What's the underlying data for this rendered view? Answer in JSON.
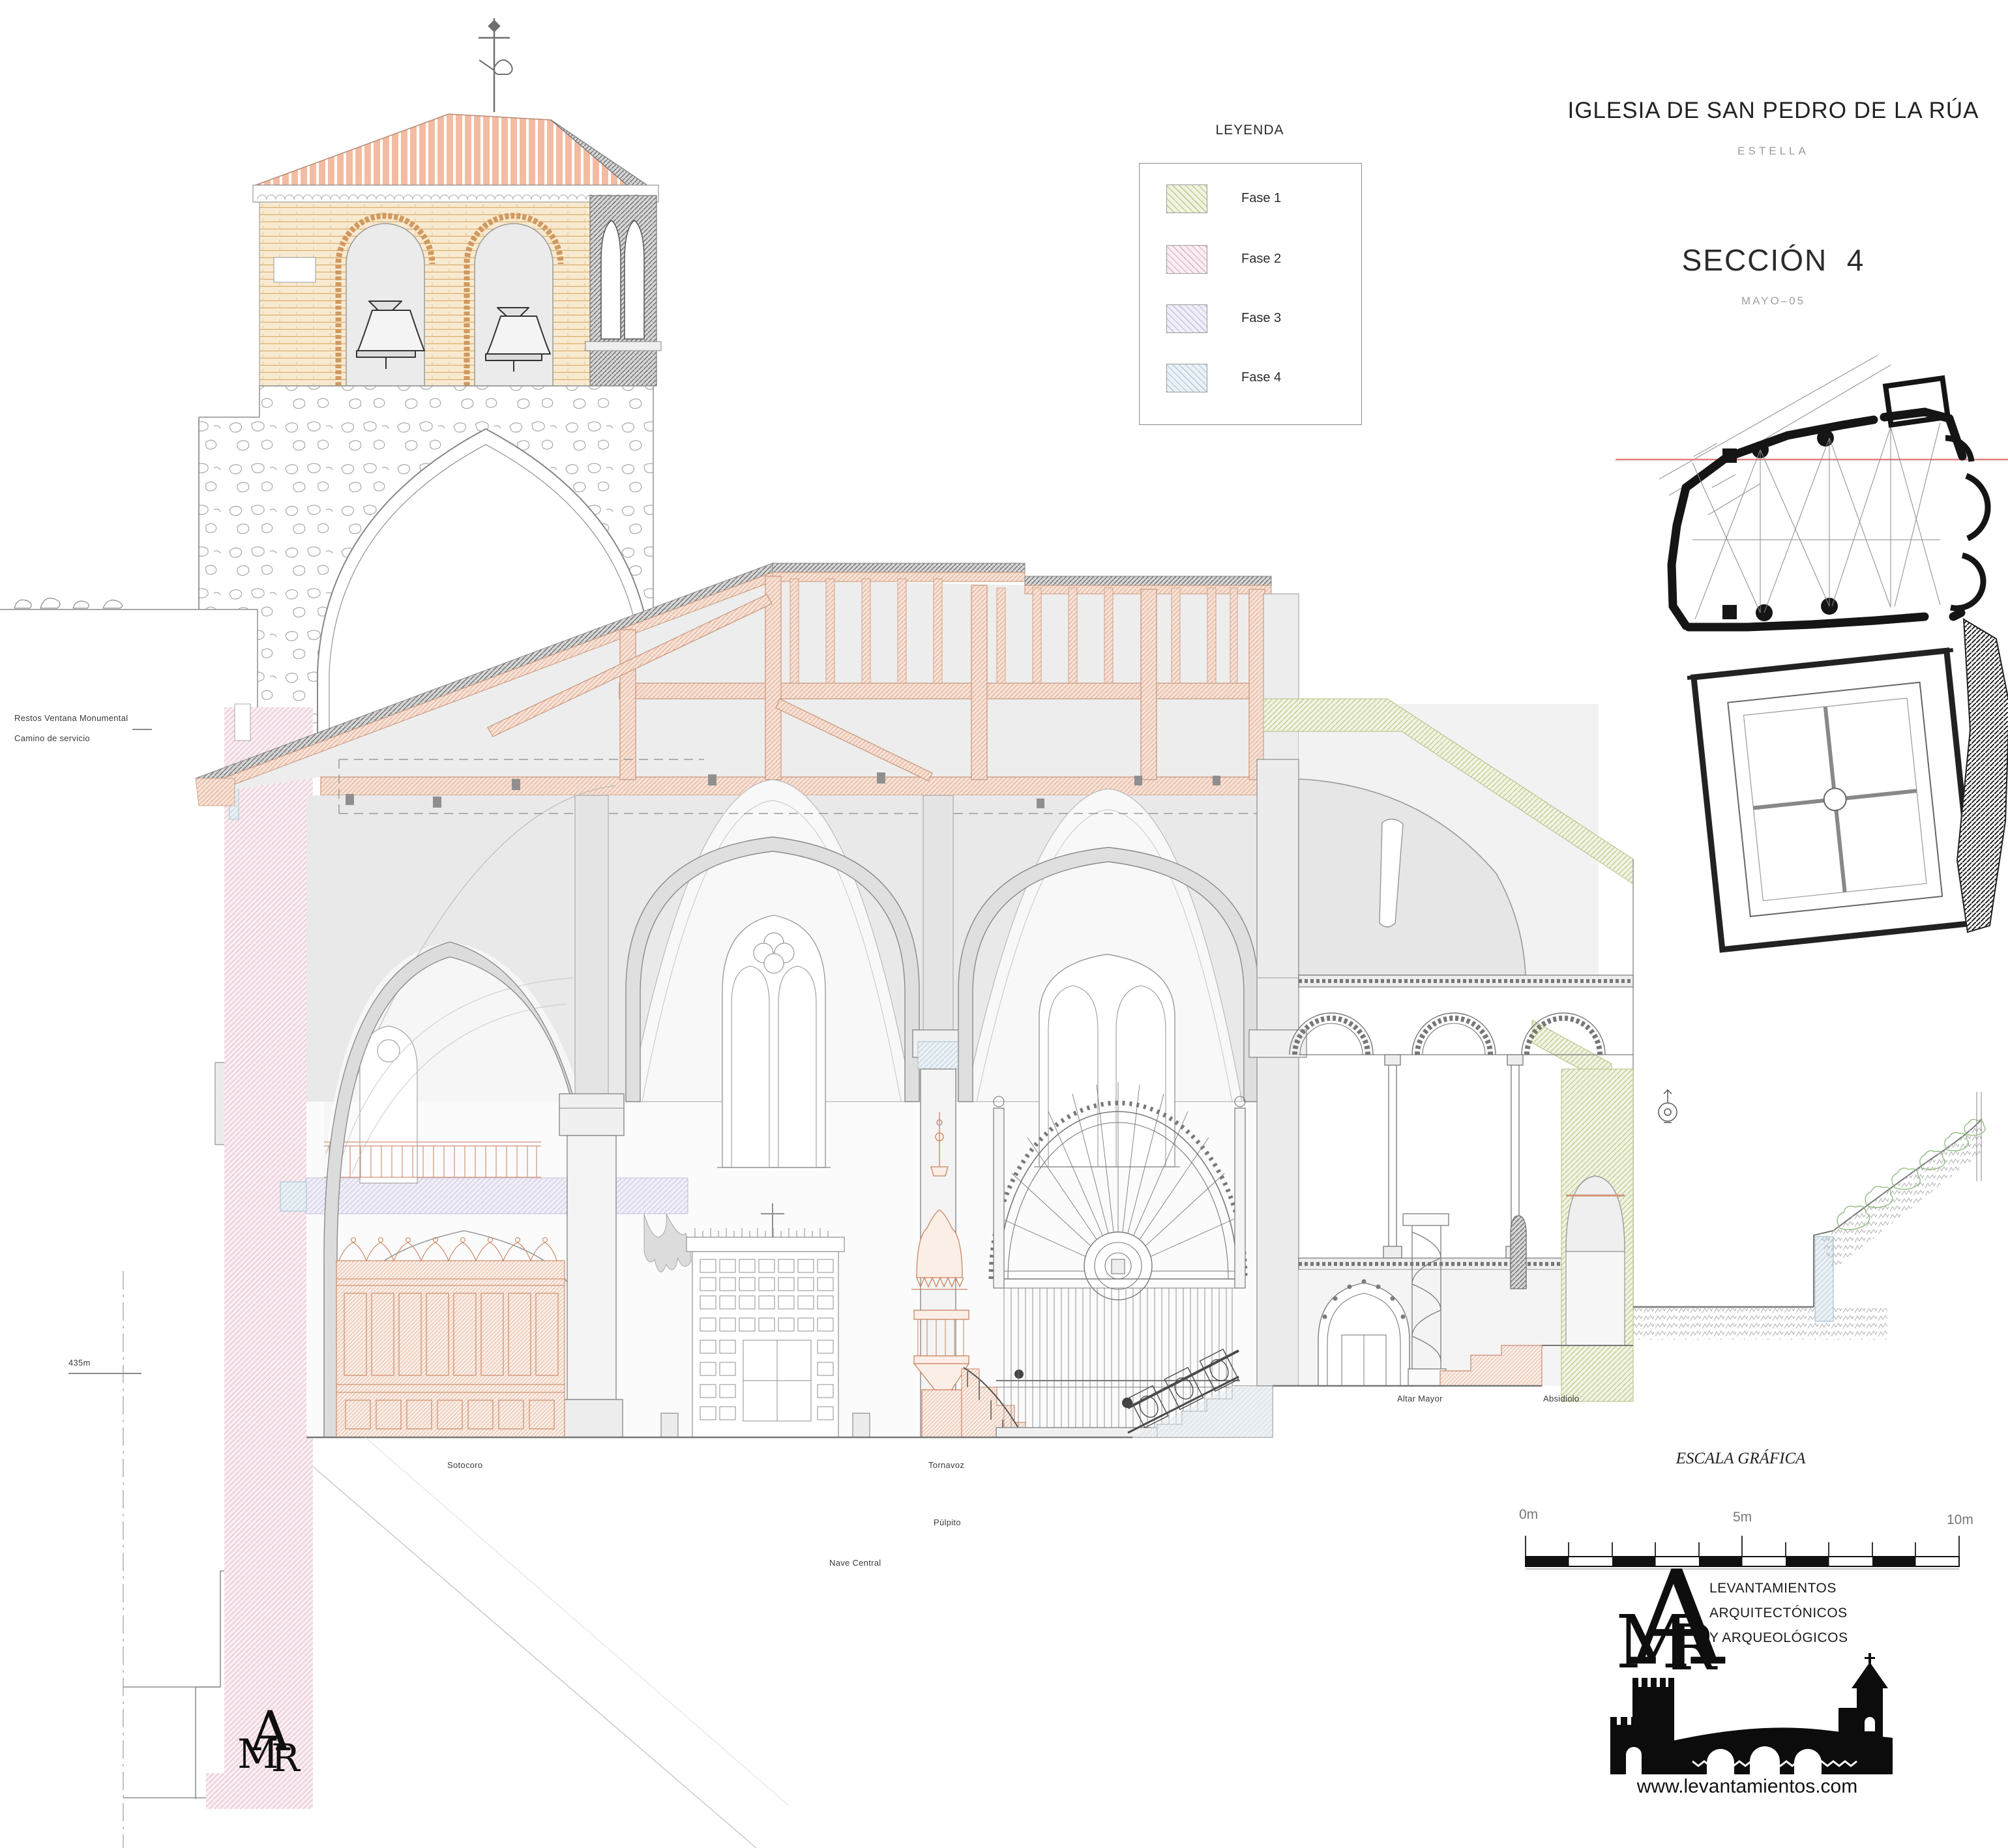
{
  "title_block": {
    "title": "IGLESIA DE SAN PEDRO DE LA RÚA",
    "subtitle": "ESTELLA",
    "section_title": "SECCIÓN  4",
    "date": "MAYO–05"
  },
  "legend": {
    "title": "LEYENDA",
    "items": [
      {
        "label": "Fase 1",
        "color": "#e8edd2"
      },
      {
        "label": "Fase 2",
        "color": "#f5e3ea"
      },
      {
        "label": "Fase 3",
        "color": "#e9e7f3"
      },
      {
        "label": "Fase 4",
        "color": "#e2ecf1"
      }
    ]
  },
  "annotations": {
    "restos_ventana": "Restos Ventana Monumental",
    "camino_servicio": "Camino de servicio",
    "datum": "435m",
    "sotocoro": "Sotocoro",
    "tornavoz": "Tornavoz",
    "pulpito": "Púlpito",
    "nave_central": "Nave Central",
    "altar_mayor": "Altar Mayor",
    "absidiolo": "Absidiolo"
  },
  "scale_bar": {
    "title": "ESCALA GRÁFICA",
    "label_0": "0m",
    "label_5": "5m",
    "label_10": "10m"
  },
  "logo": {
    "monogram_a": "A",
    "monogram_m": "M",
    "monogram_r": "R",
    "line1": "LEVANTAMIENTOS",
    "line2": "ARQUITECTÓNICOS",
    "line3": "Y ARQUEOLÓGICOS",
    "url": "www.levantamientos.com"
  },
  "colors": {
    "fase1_hatch": "#c2cc90",
    "fase2_hatch": "#e4b9c9",
    "fase3_hatch": "#c9c4e0",
    "fase4_hatch": "#b9cfdc",
    "roof_tile": "#f2b89e",
    "belfry_brick": "#f8ead0",
    "wood_truss": "#e8b49c",
    "plan_section_line": "#e08080",
    "drawing_line": "#8c8c8c"
  }
}
